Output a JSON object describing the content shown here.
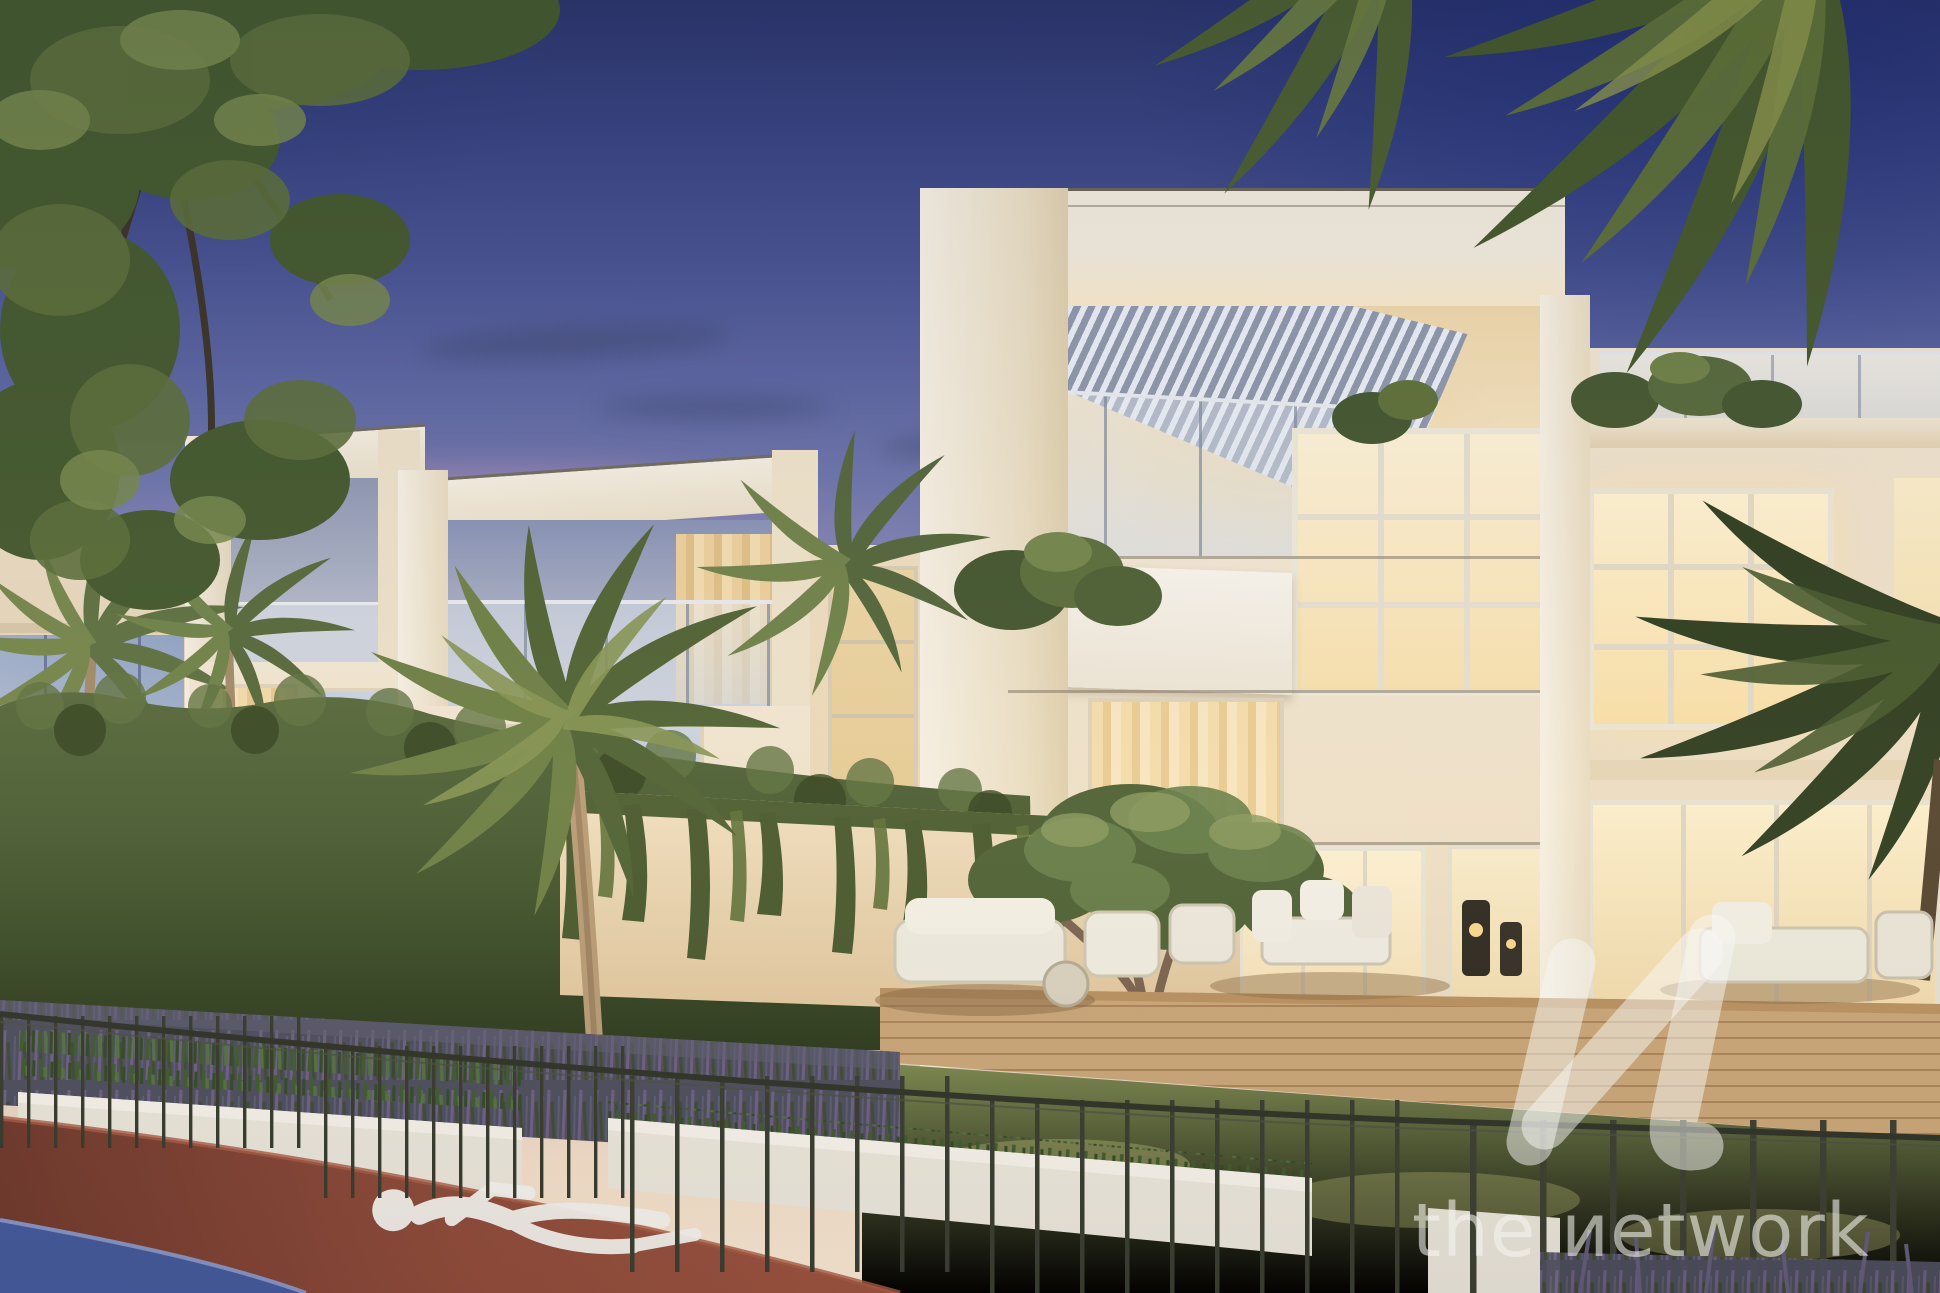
{
  "image": {
    "type": "architectural-exterior-render",
    "scene": "Modern white townhouses at dusk with lit interiors, rooftop pergola, landscaped lavender garden, metal fence, palm trees and a curved red jogging track with blue cycle lane",
    "time_of_day": "dusk"
  },
  "watermark": {
    "brand_text": "the иetwork",
    "logo_glyph": "и",
    "color": "#f5f4f0",
    "opacity": 0.55
  },
  "palette": {
    "sky_top": "#2b3468",
    "sky_mid": "#8f92bb",
    "sky_horizon": "#f6e7d2",
    "sunset_pink": "#d896ba",
    "facade_cream": "#f1e6d2",
    "window_glow": "#ffeec2",
    "glass_reflection": "#aab6cc",
    "pergola_louver": "#8e97ab",
    "foliage_green": "#55683a",
    "hedge_green": "#3f5230",
    "lavender_bed": "#55566b",
    "track_red": "#8d4a3a",
    "track_blue": "#42589b",
    "deck_wood": "#c9a678",
    "fence_metal": "#383c30",
    "planter_white": "#eae6dc"
  }
}
